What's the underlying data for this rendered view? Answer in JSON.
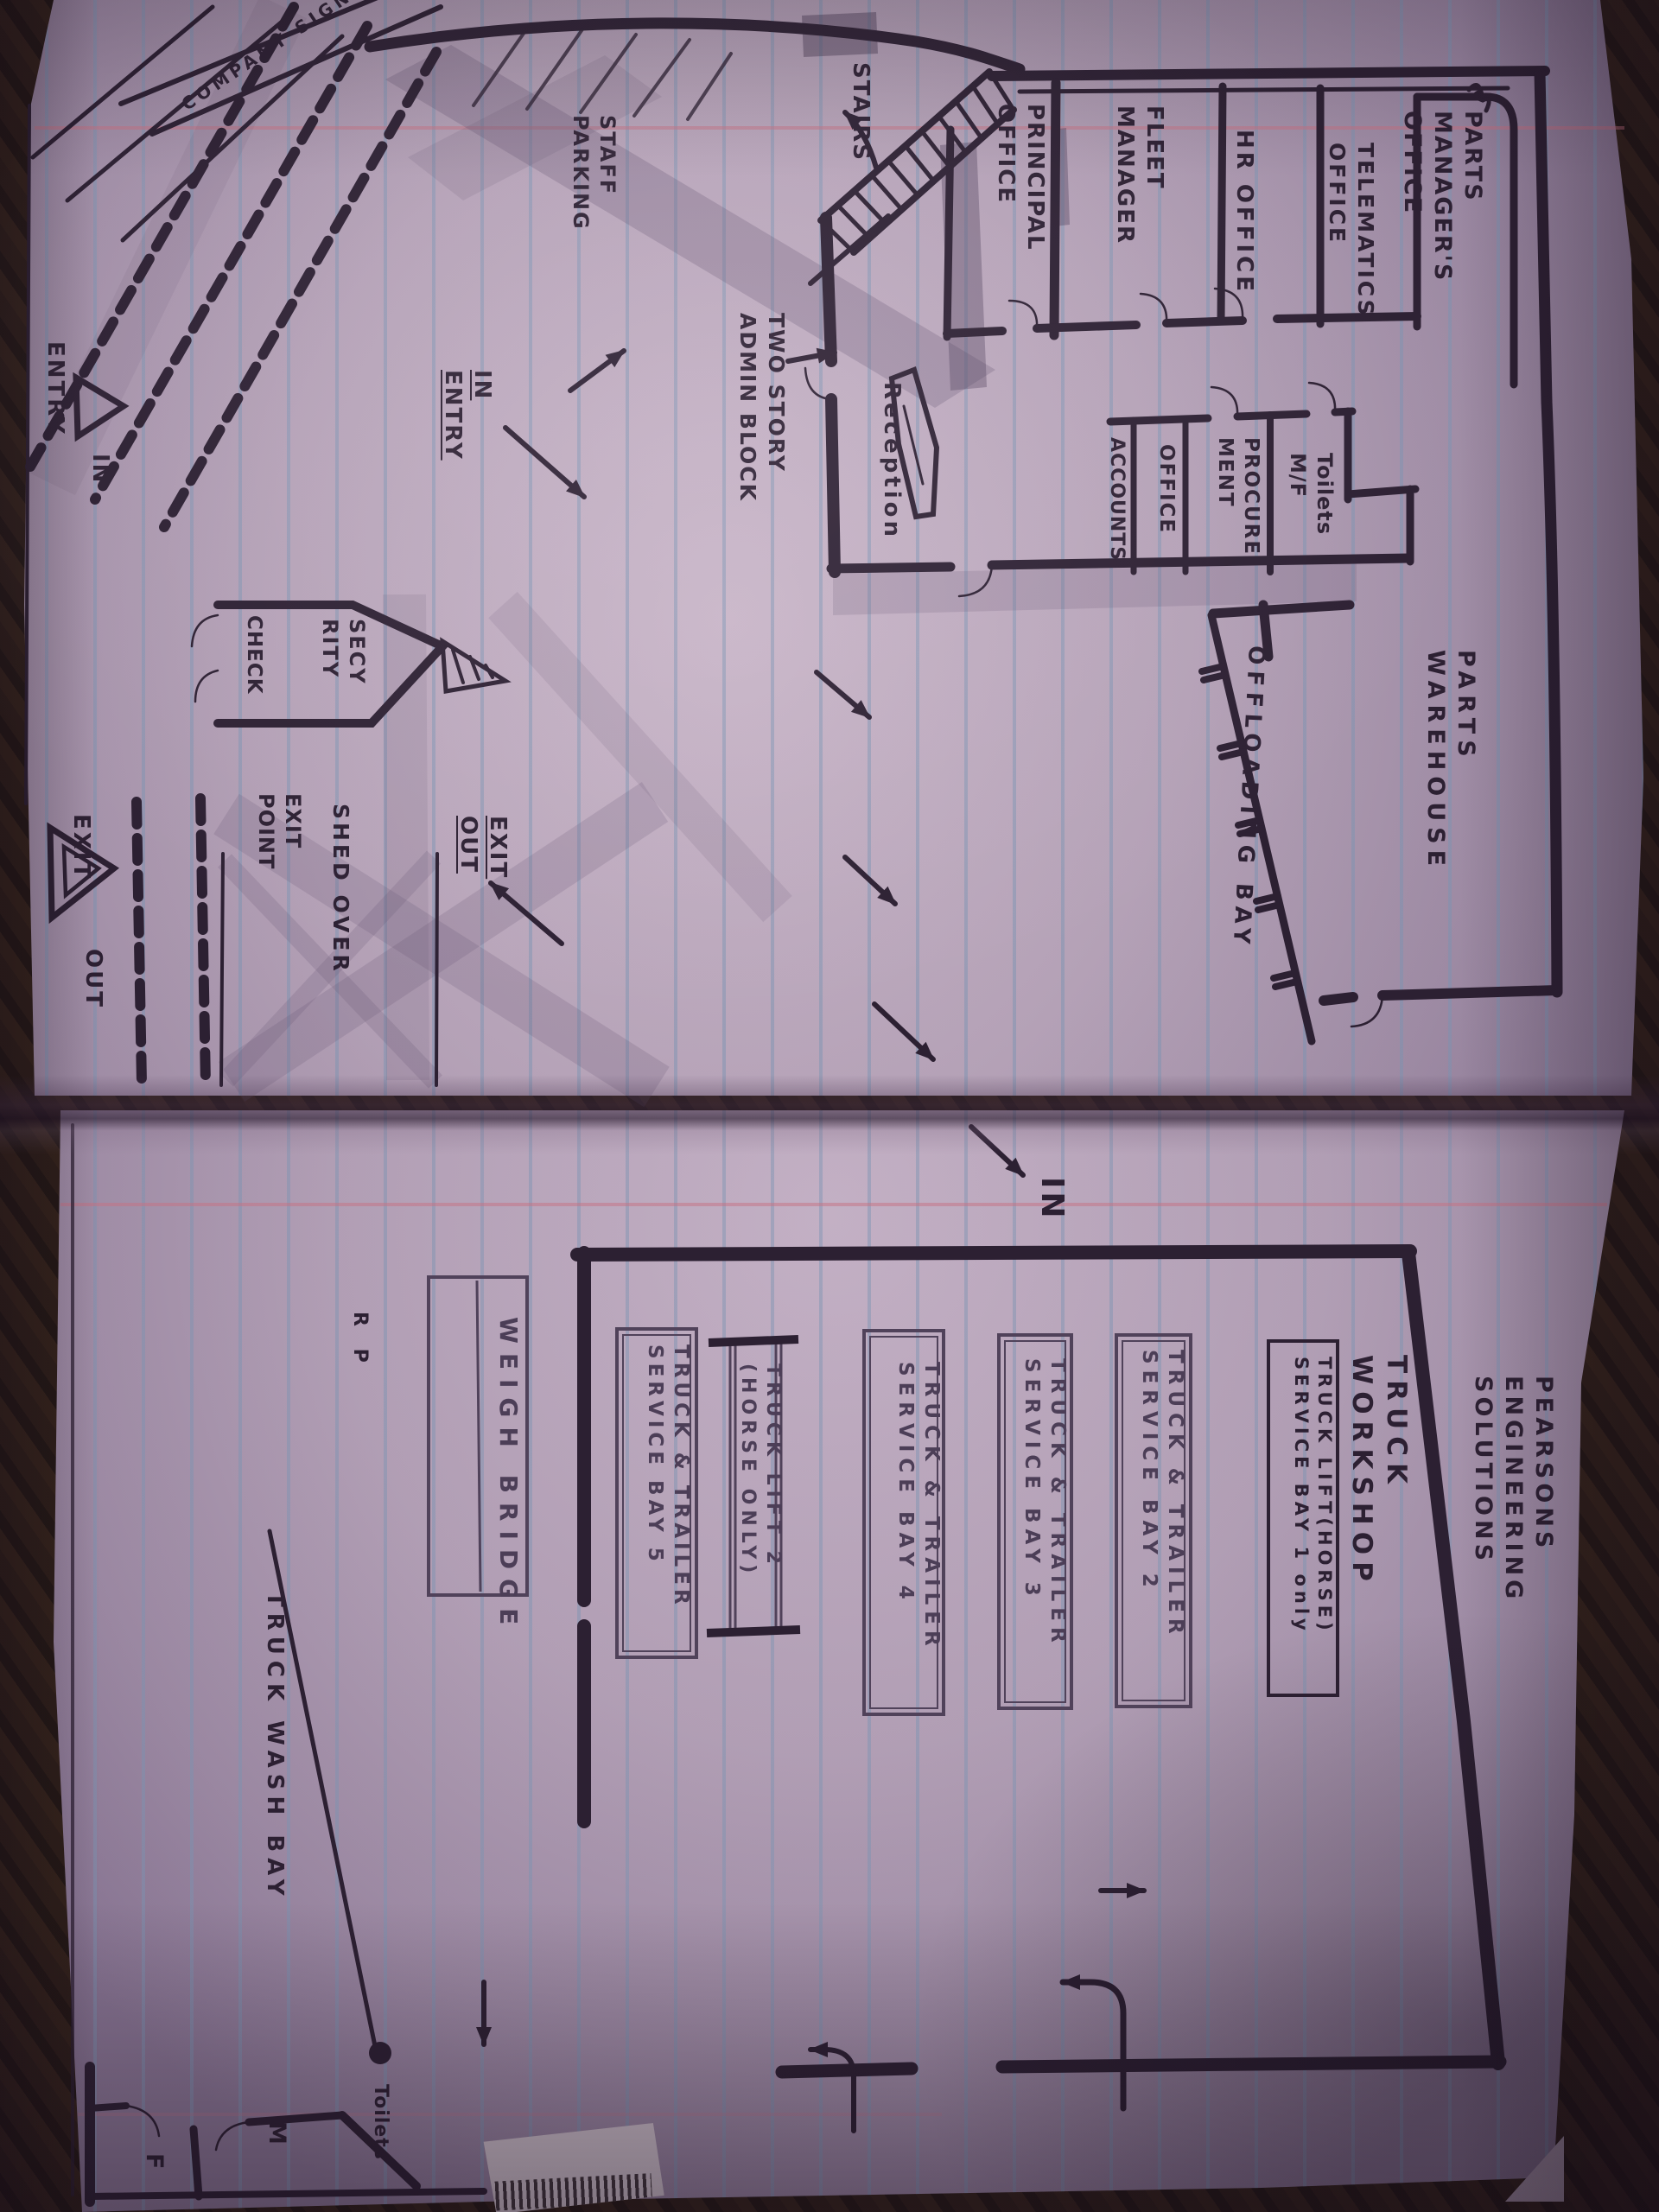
{
  "colors": {
    "ink": "#241a2b",
    "pencil": "#5f5068",
    "paper": "#b4a3b7",
    "rule_blue": "#7694b2",
    "margin_red": "#c77080",
    "background_wood": "#221710"
  },
  "left": {
    "signage": "COMPANY SIGNAGE",
    "parts_manager": "PARTS\nMANAGER'S\nOFFICE",
    "telematics": "TELEMATICS\nOFFICE",
    "hr": "HR OFFICE",
    "fleet": "FLEET\nMANAGER",
    "principal": "PRINCIPAL\nOFFICE",
    "stairs": "STAIRS",
    "toilets": "Toilets\nM/F",
    "procurement": "PROCURE\nMENT",
    "office": "OFFICE",
    "accounts": "ACCOUNTS",
    "reception": "Reception",
    "admin_block": "TWO STORY\nADMIN BLOCK",
    "staff_parking": "STAFF\nPARKING",
    "in_entry": "IN\nENTRY",
    "entry": "ENTRY",
    "in_top": "IN",
    "security_1": "SECY\nRITY",
    "security_2": "CHECK",
    "shed_over": "SHED OVER",
    "exit_point": "EXIT\nPOINT",
    "exit_out": "EXIT\nOUT",
    "exit_b": "EXIT",
    "out_b": "OUT",
    "warehouse": "PARTS\nWAREHOUSE",
    "offloading": "OFFLOADING BAY"
  },
  "right": {
    "title": "PEARSONS ENGINEERING SOLUTIONS",
    "workshop": "TRUCK WORKSHOP",
    "bay1": "TRUCK LIFT(HORSE)\nSERVICE BAY 1 only",
    "bay2": "TRUCK & TRAILER\nSERVICE BAY 2",
    "bay3": "TRUCK & TRAILER\nSERVICE BAY 3",
    "bay4": "TRUCK & TRAILER\nSERVICE BAY 4",
    "lift2": "TRUCK LIFT 2\n(HORSE ONLY)",
    "bay5": "TRUCK & TRAILER\nSERVICE BAY 5",
    "weigh_bridge": "WEIGH BRIDGE",
    "wash_bay": "TRUCK WASH BAY",
    "in_gate": "IN",
    "toilets": "Toilets",
    "m": "M",
    "f": "F",
    "initials": "R P"
  }
}
